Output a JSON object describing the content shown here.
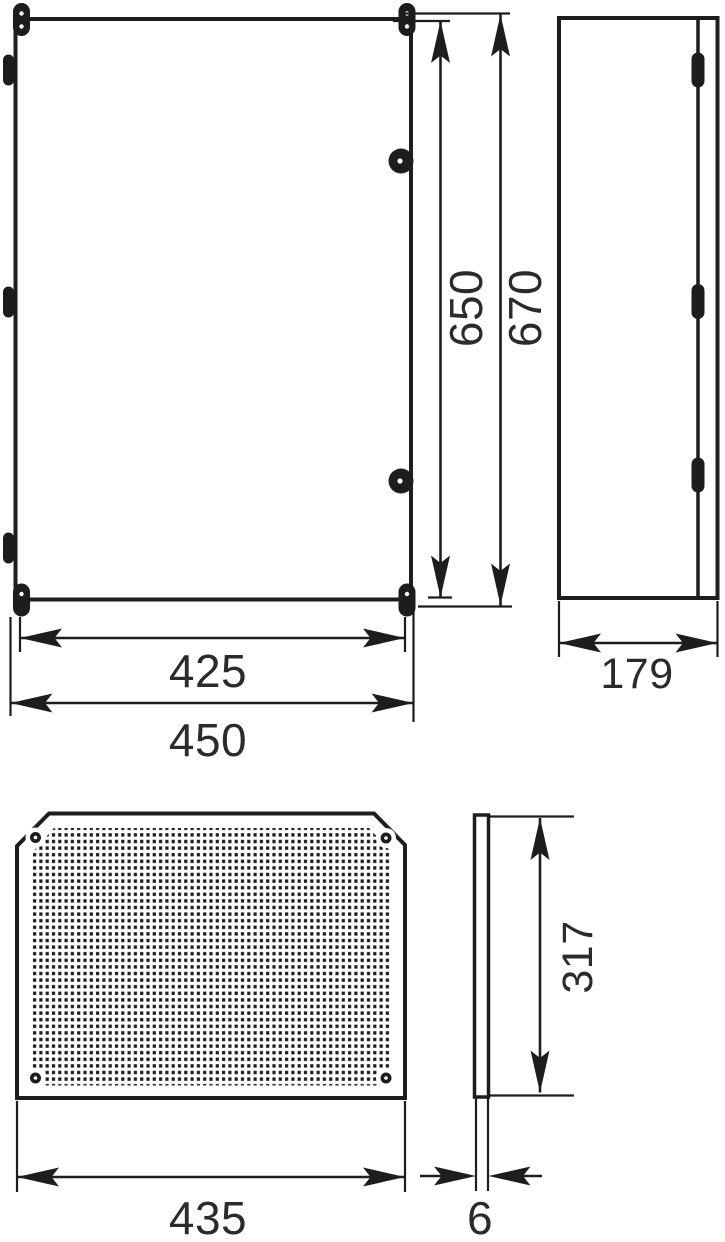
{
  "drawing": {
    "subject": "Wall-mounted enclosure dimensional drawing with perforated mounting plate",
    "units": "mm",
    "ink_color": "#1d1d1b",
    "background_color": "#ffffff",
    "views": {
      "front": {
        "name": "enclosure front view",
        "door_height": "650",
        "overall_height": "670",
        "door_width": "425",
        "overall_width": "450"
      },
      "side": {
        "name": "enclosure side view",
        "depth": "179"
      },
      "plate": {
        "name": "mounting plate front view",
        "width": "435"
      },
      "plate_edge": {
        "name": "mounting plate edge view",
        "height": "317",
        "thickness": "6"
      }
    }
  }
}
